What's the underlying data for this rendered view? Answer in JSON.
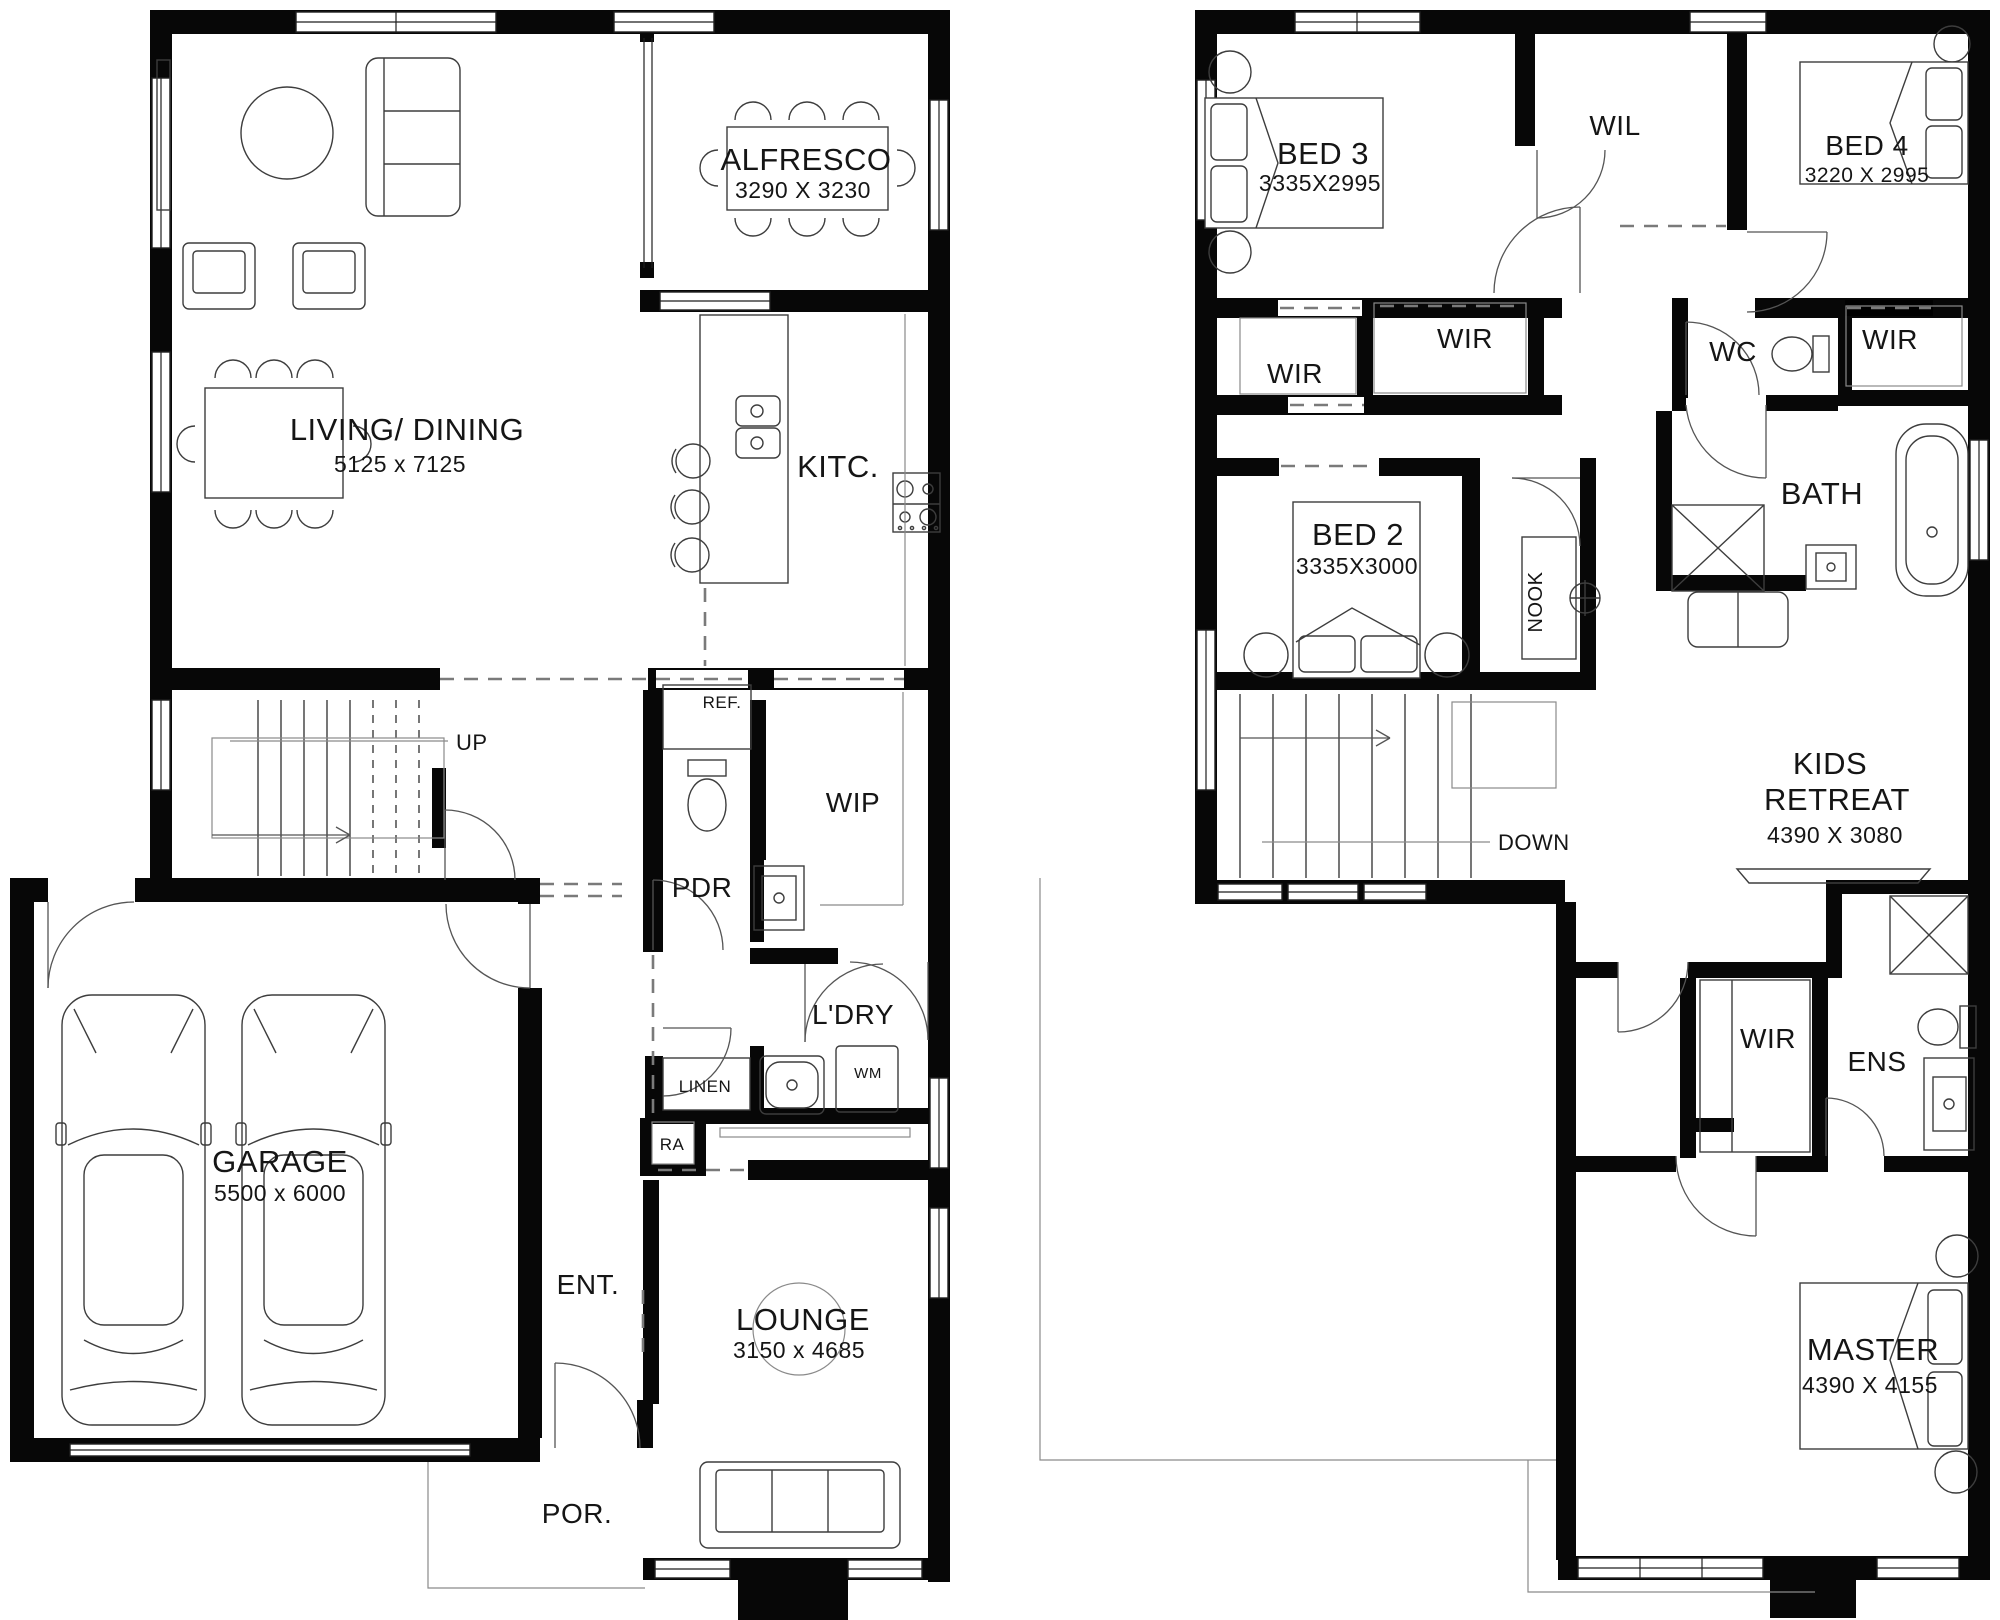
{
  "ground_floor": {
    "alfresco": {
      "name": "ALFRESCO",
      "dims": "3290 X 3230"
    },
    "living_dining": {
      "name": "LIVING/ DINING",
      "dims": "5125 x 7125"
    },
    "kitchen": {
      "name": "KITC."
    },
    "fridge": {
      "name": "REF."
    },
    "stairs": {
      "name": "UP"
    },
    "wip": {
      "name": "WIP"
    },
    "pdr": {
      "name": "PDR"
    },
    "laundry": {
      "name": "L'DRY"
    },
    "linen": {
      "name": "LINEN"
    },
    "washing_machine": {
      "name": "WM"
    },
    "return_air": {
      "name": "RA"
    },
    "garage": {
      "name": "GARAGE",
      "dims": "5500 x 6000"
    },
    "entry": {
      "name": "ENT."
    },
    "lounge": {
      "name": "LOUNGE",
      "dims": "3150 x 4685"
    },
    "porch": {
      "name": "POR."
    }
  },
  "first_floor": {
    "bed3": {
      "name": "BED 3",
      "dims": "3335X2995"
    },
    "wil": {
      "name": "WIL"
    },
    "bed4": {
      "name": "BED 4",
      "dims": "3220 X 2995"
    },
    "wir_bed3": {
      "name": "WIR"
    },
    "wir_hall": {
      "name": "WIR"
    },
    "wc": {
      "name": "WC"
    },
    "wir_bed4": {
      "name": "WIR"
    },
    "bath": {
      "name": "BATH"
    },
    "bed2": {
      "name": "BED 2",
      "dims": "3335X3000"
    },
    "nook": {
      "name": "NOOK"
    },
    "stairs": {
      "name": "DOWN"
    },
    "kids_retreat": {
      "line1": "KIDS",
      "line2": "RETREAT",
      "dims": "4390 X 3080"
    },
    "wir_master": {
      "name": "WIR"
    },
    "ens": {
      "name": "ENS"
    },
    "master": {
      "name": "MASTER",
      "dims": "4390 X 4155"
    }
  }
}
